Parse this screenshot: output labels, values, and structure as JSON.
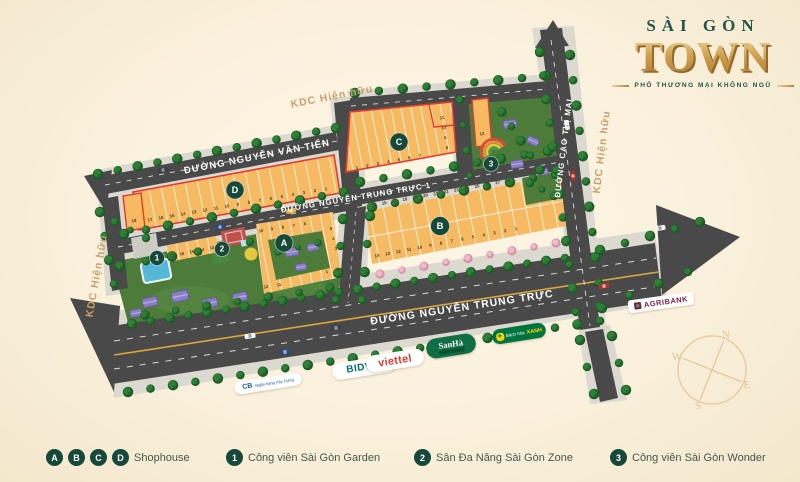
{
  "logo": {
    "top": "SÀI GÒN",
    "main": "TOWN",
    "tagline": "PHỐ THƯƠNG MẠI KHÔNG NGỦ"
  },
  "streets": {
    "van_tien": "ĐƯỜNG NGUYỄN VĂN TIẾN",
    "trung_truc_1": "ĐƯỜNG NGUYỄN TRUNG TRỰC 1",
    "trung_truc": "ĐƯỜNG NGUYỄN TRUNG TRỰC",
    "cao_thi_mai": "ĐƯỜNG CAO THỊ MAI"
  },
  "areas": {
    "kdc": "KDC Hiện hữu"
  },
  "blocks": {
    "A": {
      "label": "A",
      "top": [
        "10",
        "9",
        "8",
        "7",
        "6"
      ],
      "right": [
        "5",
        "4",
        "3"
      ],
      "bottom_right": [
        "1",
        "2"
      ],
      "bottom_left": [
        "12",
        "11"
      ],
      "west_strip": [
        "17",
        "16",
        "15",
        "14",
        "13"
      ]
    },
    "B": {
      "label": "B",
      "top": [
        "15",
        "16",
        "17",
        "18",
        "19",
        "20",
        "21",
        "22",
        "23",
        "24",
        "25",
        "26",
        "27",
        "28"
      ],
      "bottom": [
        "14",
        "13",
        "12",
        "11",
        "10",
        "9",
        "8",
        "7",
        "6",
        "5",
        "4",
        "3",
        "2",
        "1"
      ]
    },
    "C": {
      "label": "C",
      "bottom": [
        "1",
        "2",
        "3",
        "4",
        "5",
        "6",
        "7"
      ],
      "right": [
        "8",
        "9",
        "10",
        "11"
      ],
      "separate": "12"
    },
    "D": {
      "label": "D",
      "bottom": [
        "17",
        "16",
        "15",
        "14",
        "13",
        "12",
        "11",
        "10",
        "9",
        "8",
        "7",
        "6",
        "5",
        "4",
        "3",
        "2",
        "1"
      ],
      "separate": "18"
    }
  },
  "markers": {
    "m1": "1",
    "m2": "2",
    "m3": "3"
  },
  "compass": {
    "n": "N",
    "e": "E",
    "s": "S",
    "w": "W"
  },
  "legend": {
    "shophouse_icons": [
      "A",
      "B",
      "C",
      "D"
    ],
    "shophouse": "Shophouse",
    "item1_icon": "1",
    "item1": "Công viên Sài Gòn Garden",
    "item2_icon": "2",
    "item2": "Sân Đa Năng Sài Gòn Zone",
    "item3_icon": "3",
    "item3": "Công viên Sài Gòn Wonder"
  },
  "brands": {
    "cb_name": "CB",
    "cb_sub": "Ngân hàng Xây Dựng",
    "bidv": "BIDV",
    "bidv_icon": "✿",
    "viettel": "viettel",
    "sanha": "SanHà",
    "bhx_pre": "Bách hóa",
    "bhx_hl": "XANH",
    "agribank": "AGRIBANK"
  },
  "colors": {
    "accent_green": "#17493a",
    "block_orange": "#f6ba62",
    "red_border": "#e23b2e",
    "road": "#494949",
    "kdc_tan": "#c9a06c",
    "gold": "#c9973f"
  }
}
